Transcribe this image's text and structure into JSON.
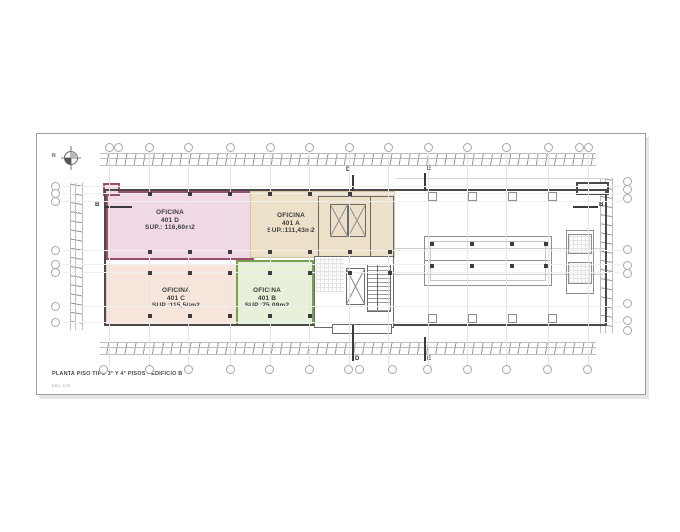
{
  "sheet": {
    "title": "PLANTA PISO TIPO 3° Y 4° PISOS - EDIFICIO B",
    "scale_note": "ESC. 1/75",
    "north_label": "N"
  },
  "offices": [
    {
      "name_line": "OFICINA",
      "number": "401 D",
      "area": "SUP.: 116,60m2",
      "fill": "#f0d9e4",
      "border": "#9a4f6e"
    },
    {
      "name_line": "OFICINA",
      "number": "401 A",
      "area": "SUP.:111,43m2",
      "fill": "#ece0c9",
      "border": "#d6c7a0"
    },
    {
      "name_line": "OFICINA",
      "number": "401 C",
      "area": "SUP.:115,58m2",
      "fill": "#f8e6dd",
      "border": "#e3c9ba"
    },
    {
      "name_line": "OFICINA",
      "number": "401 B",
      "area": "SUP.:75,09m2",
      "fill": "#e7f0d8",
      "border": "#76a050"
    }
  ],
  "sections": {
    "d_label": "D",
    "e_label": "E",
    "b_label": "B"
  },
  "colors": {
    "building_outline": "#4a4a4a",
    "grid_line": "#e4e4e4",
    "dimension_line": "#bdbdbd",
    "column": "#3d3d3d",
    "sheet_border": "#9e9e9e"
  },
  "plan": {
    "axes_x": [
      109,
      149,
      188,
      230,
      270,
      309,
      349,
      388,
      428,
      467,
      506,
      548,
      588
    ],
    "axes_y": [
      186,
      193,
      201,
      250,
      264,
      272,
      306,
      322
    ],
    "grid": {
      "top_x": [
        109,
        118,
        149,
        188,
        230,
        270,
        309,
        349,
        388,
        428,
        467,
        506,
        548,
        579,
        588
      ],
      "bottom_x": [
        103,
        149,
        188,
        230,
        269,
        309,
        348,
        359,
        392,
        427,
        467,
        506,
        547,
        587
      ],
      "left_y": [
        186,
        193,
        201,
        250,
        264,
        272,
        306,
        322
      ],
      "right_y": [
        181,
        189,
        198,
        249,
        265,
        273,
        303,
        320,
        330
      ]
    },
    "columns": {
      "solid": [
        [
          148,
          192
        ],
        [
          188,
          192
        ],
        [
          228,
          192
        ],
        [
          268,
          192
        ],
        [
          308,
          192
        ],
        [
          348,
          192
        ],
        [
          148,
          250
        ],
        [
          188,
          250
        ],
        [
          228,
          250
        ],
        [
          268,
          250
        ],
        [
          308,
          250
        ],
        [
          348,
          250
        ],
        [
          388,
          250
        ],
        [
          148,
          271
        ],
        [
          188,
          271
        ],
        [
          228,
          271
        ],
        [
          268,
          271
        ],
        [
          308,
          271
        ],
        [
          348,
          271
        ],
        [
          388,
          271
        ],
        [
          148,
          314
        ],
        [
          188,
          314
        ],
        [
          228,
          314
        ],
        [
          268,
          314
        ],
        [
          308,
          314
        ],
        [
          430,
          242
        ],
        [
          470,
          242
        ],
        [
          510,
          242
        ],
        [
          544,
          242
        ],
        [
          430,
          264
        ],
        [
          470,
          264
        ],
        [
          510,
          264
        ],
        [
          544,
          264
        ]
      ],
      "outline": [
        [
          428,
          192
        ],
        [
          468,
          192
        ],
        [
          508,
          192
        ],
        [
          548,
          192
        ],
        [
          428,
          314
        ],
        [
          468,
          314
        ],
        [
          508,
          314
        ],
        [
          548,
          314
        ]
      ]
    }
  }
}
